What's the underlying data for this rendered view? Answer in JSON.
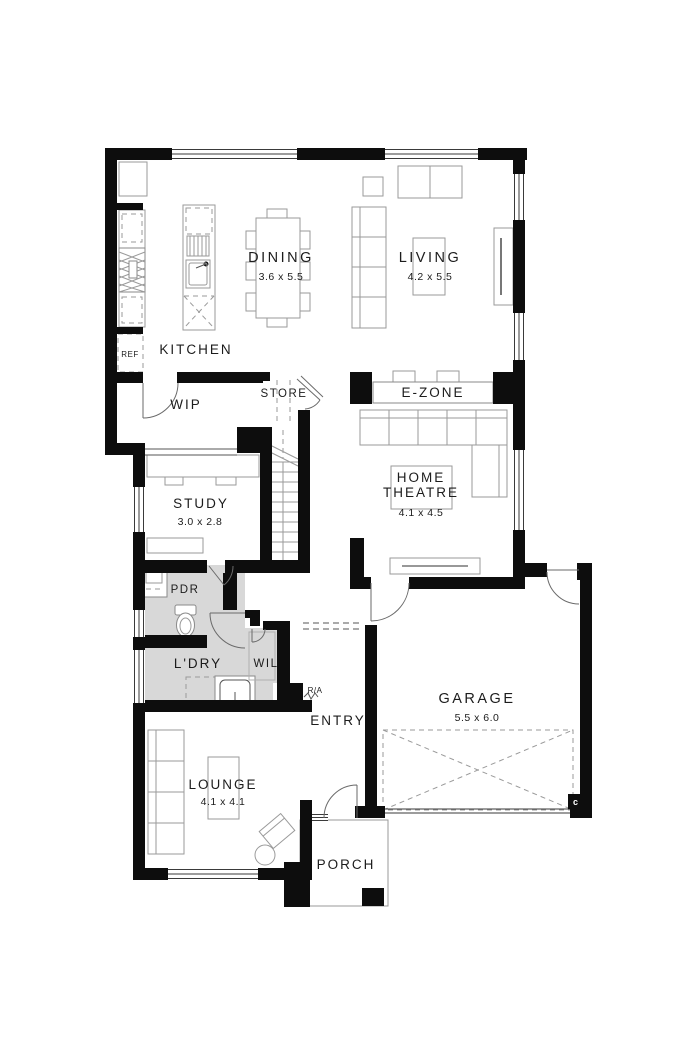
{
  "plan_title": "single-storey-floor-plan",
  "colors": {
    "wall": "#0d0d0d",
    "shaded_room": "#d8d8d8",
    "furniture_line": "#9a9a9a",
    "background": "#ffffff",
    "label_text": "#1c1c1c"
  },
  "rooms": {
    "kitchen": {
      "name": "KITCHEN"
    },
    "dining": {
      "name": "DINING",
      "dim": "3.6 x 5.5"
    },
    "living": {
      "name": "LIVING",
      "dim": "4.2 x 5.5"
    },
    "wip": {
      "name": "WIP"
    },
    "store": {
      "name": "STORE"
    },
    "ezone": {
      "name": "E-ZONE"
    },
    "study": {
      "name": "STUDY",
      "dim": "3.0 x 2.8"
    },
    "home_theatre": {
      "line1": "HOME",
      "line2": "THEATRE",
      "dim": "4.1 x 4.5"
    },
    "pdr": {
      "name": "PDR"
    },
    "ldry": {
      "name": "L'DRY"
    },
    "wil": {
      "name": "WIL"
    },
    "entry": {
      "name": "ENTRY"
    },
    "garage": {
      "name": "GARAGE",
      "dim": "5.5 x 6.0"
    },
    "lounge": {
      "name": "LOUNGE",
      "dim": "4.1 x 4.1"
    },
    "porch": {
      "name": "PORCH"
    }
  },
  "labels": {
    "fridge": "REF",
    "return_air": "R/A",
    "column_marker": "c"
  }
}
